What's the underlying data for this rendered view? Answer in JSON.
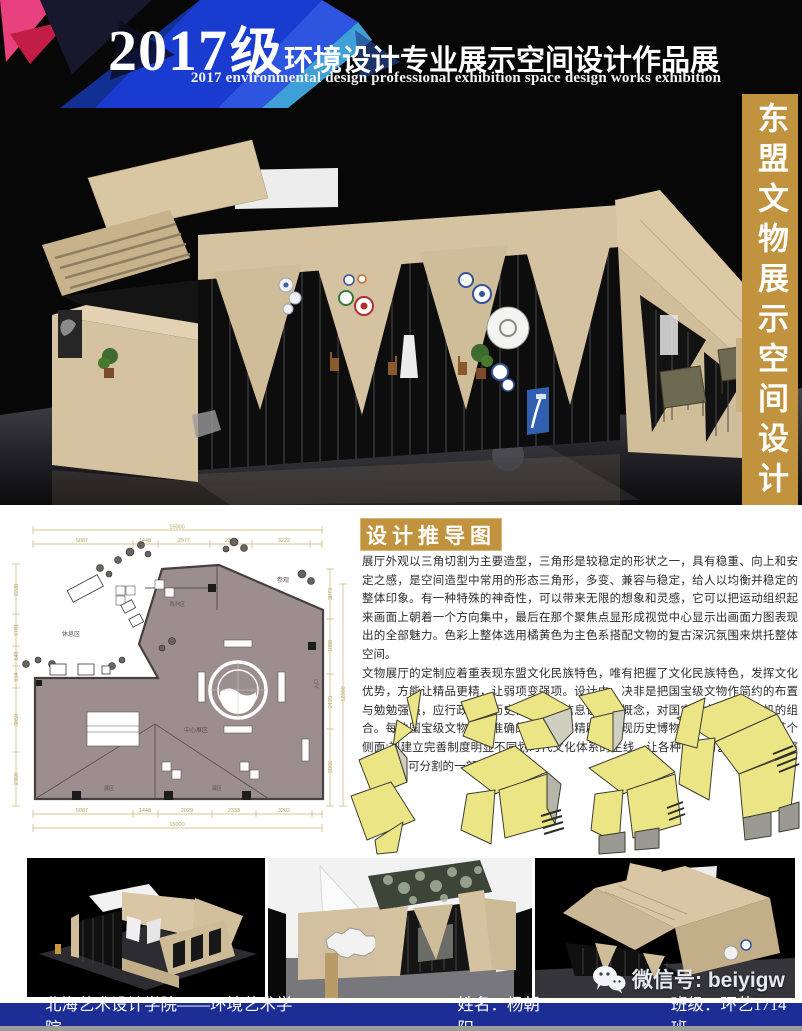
{
  "header": {
    "year": "2017",
    "grade": "级",
    "title_cn": "环境设计专业展示空间设计作品展",
    "title_en": "2017 environmental design professional exhibition space design works exhibition"
  },
  "sidebar": {
    "vertical_title": "东盟文物展示空间设计"
  },
  "derivation": {
    "section_title": "设计推导图",
    "paragraph1": "展厅外观以三角切割为主要造型，三角形是较稳定的形状之一，具有稳重、向上和安定之感，是空间造型中常用的形态三角形，多变、兼容与稳定，给人以均衡并稳定的整体印象。有一种特殊的神奇性，可以带来无限的想象和灵感，它可以把运动组织起来画面上朝着一个方向集中，最后在那个聚焦点显形成视觉中心显示出画面力图表现出的全部魅力。色彩上整体选用橘黄色为主色系搭配文物的复古深沉氛围来烘托整体空间。",
    "paragraph2": "文物展厅的定制应着重表现东盟文化民族特色，唯有把握了文化民族特色，发挥文化优势，方能让精品更精，让弱项变强项。设计中，决非是把国宝级文物作简约的布置与勉勉强强，应行政规章历史博物馆的信息设计的概念，对国宝级文物进行有机的组合。每件国宝级文物都有准确的定位，并精辟地表现历史博物馆文化民族特色的某个侧面:视建立完善制度明显不同划时代文化体系的主线，让各种各样的艺伎偶都成为整个体系不可分割的一部分。"
  },
  "floorplan": {
    "labels": {
      "rest_area": "休息区",
      "display_area": "陈列区",
      "center_area": "中心展区",
      "visit": "参观",
      "entrance": "入口",
      "zone_a": "展区",
      "zone_b": "展区"
    },
    "dims": {
      "top_total": "15000",
      "top_segments": [
        "5087",
        "1448",
        "2977",
        "2346",
        "3222"
      ],
      "bottom_segments": [
        "5087",
        "1448",
        "2029",
        "2333",
        "3202"
      ],
      "bottom_total": "15000",
      "left": [
        "2220",
        "1781",
        "848",
        "914",
        "3050",
        "2368"
      ],
      "right": [
        "3073",
        "1008",
        "2123",
        "2066"
      ],
      "right_total": "12000"
    }
  },
  "footer": {
    "school": "北海艺术设计学院——环境艺术学院",
    "name": "姓名：杨朝阳",
    "class": "班级：环艺1714班"
  },
  "watermark": {
    "wechat": "微信号: beiyigw"
  },
  "icons": {
    "wechat": "wechat-icon"
  },
  "colors": {
    "gold": "#c1933f",
    "footer_blue": "#1c2d96",
    "header_blue": "#1a3bd0",
    "header_pink": "#e8417d",
    "plan_floor": "#9c8e8e",
    "dim_line": "#c9b471",
    "sketch_yellow": "#ece585",
    "pavilion_beige": "#d5c2a0",
    "bottom_gray": "#9b9b9b"
  }
}
